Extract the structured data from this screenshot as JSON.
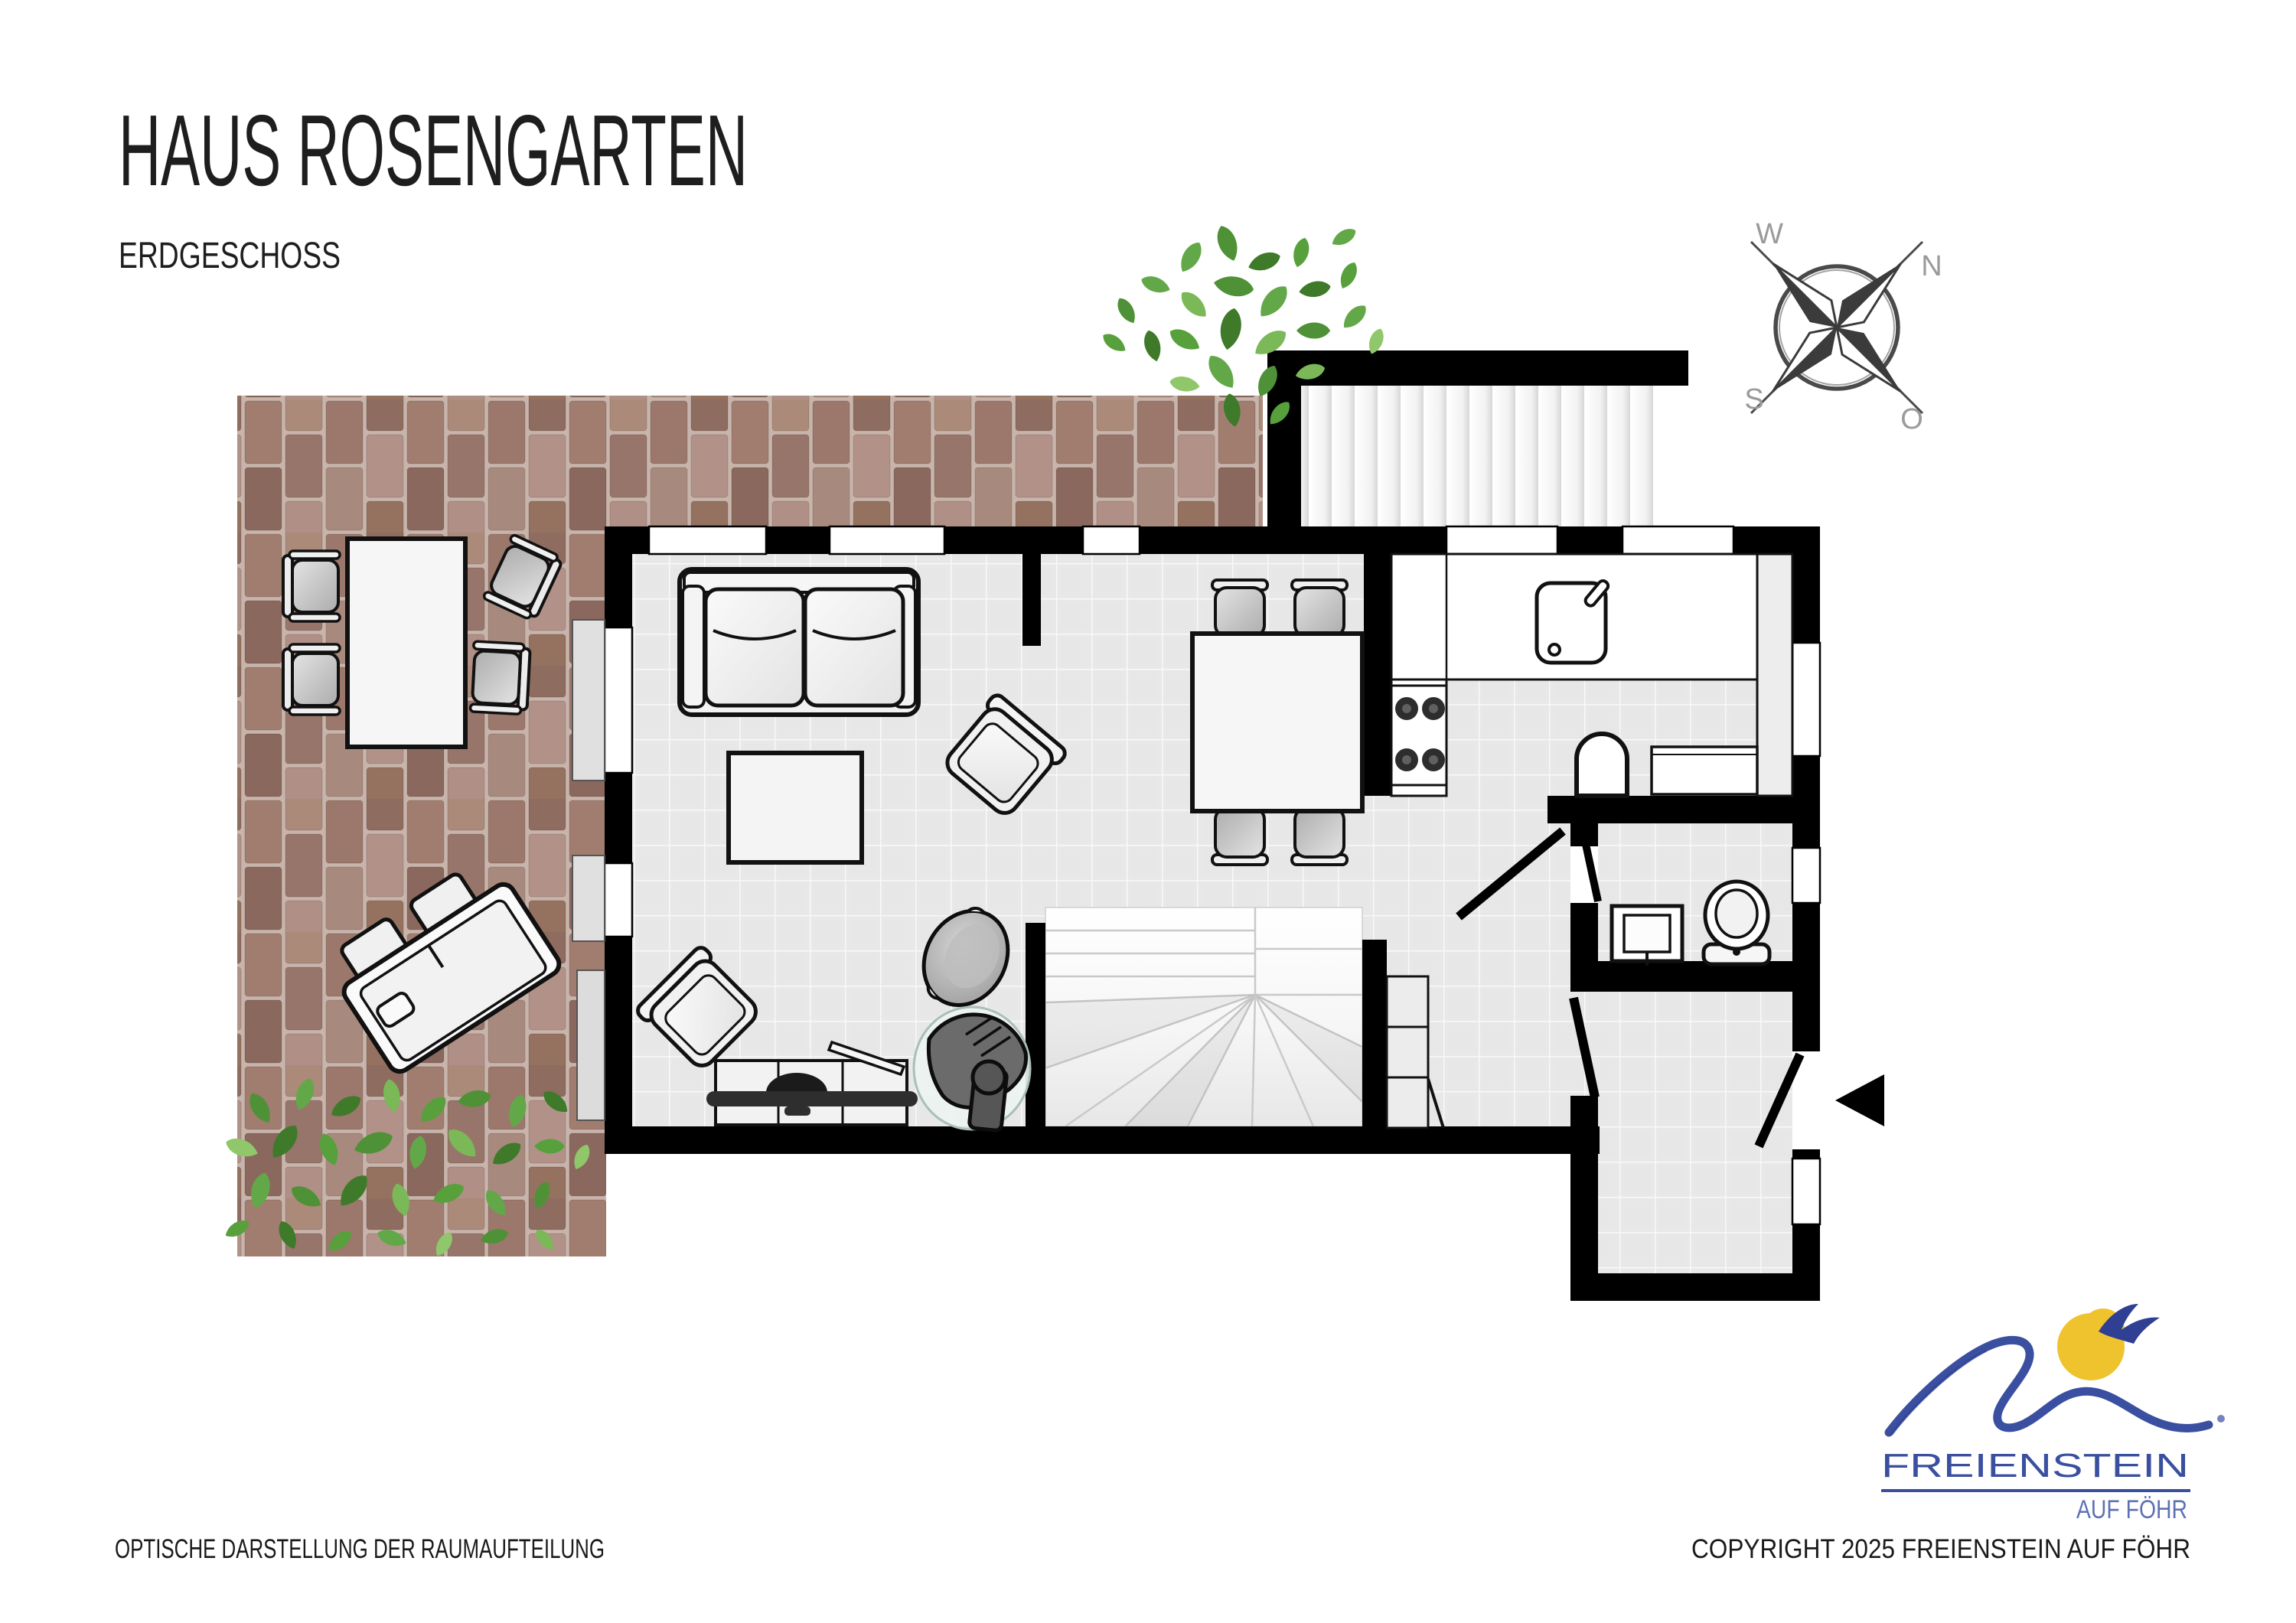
{
  "header": {
    "title": "HAUS ROSENGARTEN",
    "subtitle": "ERDGESCHOSS"
  },
  "compass": {
    "west": "W",
    "north": "N",
    "south": "S",
    "east": "O"
  },
  "logo": {
    "name": "FREIENSTEIN",
    "tagline": "AUF FÖHR",
    "brand_blue": "#3a4fa0",
    "sun_yellow": "#eec32d"
  },
  "footer": {
    "left": "OPTISCHE DARSTELLUNG DER RAUMAUFTEILUNG",
    "right": "COPYRIGHT 2025 FREIENSTEIN AUF FÖHR"
  },
  "plan": {
    "colors": {
      "wall": "#000000",
      "floor_tile": "#e8e8e8",
      "terrace_grout": "#c8b4ab",
      "terrace_bricks": [
        "#9b786b",
        "#a78a7d",
        "#8f6c60",
        "#b29288",
        "#a07d6f",
        "#95725f",
        "#ab8a7a",
        "#8a685d",
        "#97756a",
        "#b09086"
      ],
      "foliage": [
        "#3e7a2a",
        "#4f9136",
        "#63a848",
        "#7ab858",
        "#8fc76a",
        "#57a03c"
      ],
      "stove_glass": "#edf3f0"
    }
  }
}
